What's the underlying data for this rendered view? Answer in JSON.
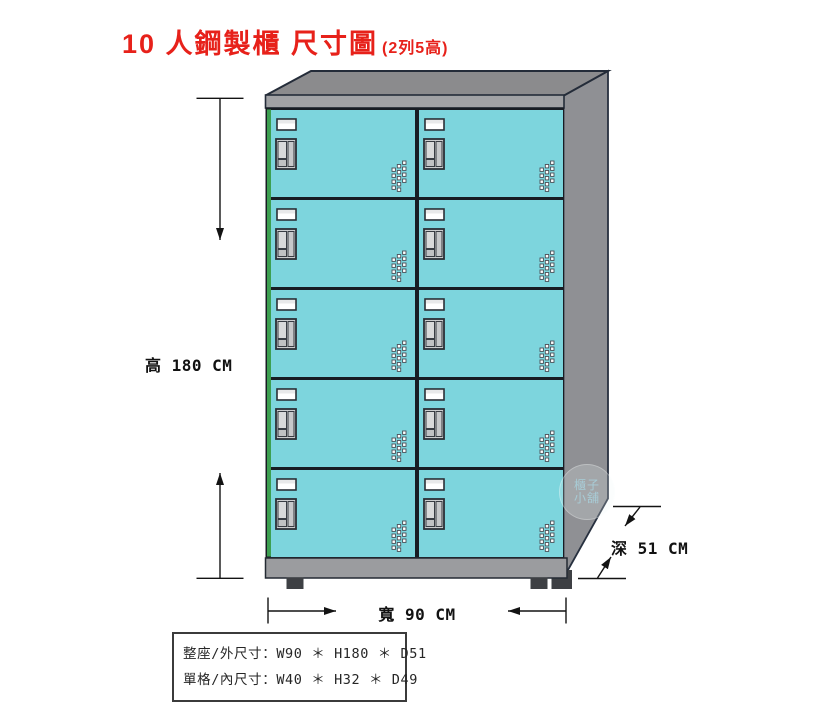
{
  "title": {
    "main": "10 人鋼製櫃 尺寸圖",
    "sub": "(2列5高)"
  },
  "cabinet": {
    "columns": 2,
    "rows": 5,
    "compartments": 10
  },
  "dimension_labels": {
    "height": "高 180 CM",
    "width": "寬 90 CM",
    "depth": "深 51 CM"
  },
  "spec_box": {
    "line1": "整座/外尺寸：W90 ＊ H180 ＊ D51",
    "line2": "單格/內尺寸：W40 ＊ H32 ＊ D49"
  },
  "watermark": {
    "line1": "櫃子",
    "line2": "小舖"
  },
  "colors": {
    "door_cyan": "#7DD5DD",
    "left_edge_green": "#3C9F50",
    "cabinet_top": "#8B8B8D",
    "cabinet_side": "#8F9094",
    "cabinet_rail": "#A1A2A5",
    "cabinet_base": "#9B9C9F",
    "foot_dark": "#3E4044",
    "outline_dark": "#242C39",
    "title_red": "#E7211A"
  }
}
